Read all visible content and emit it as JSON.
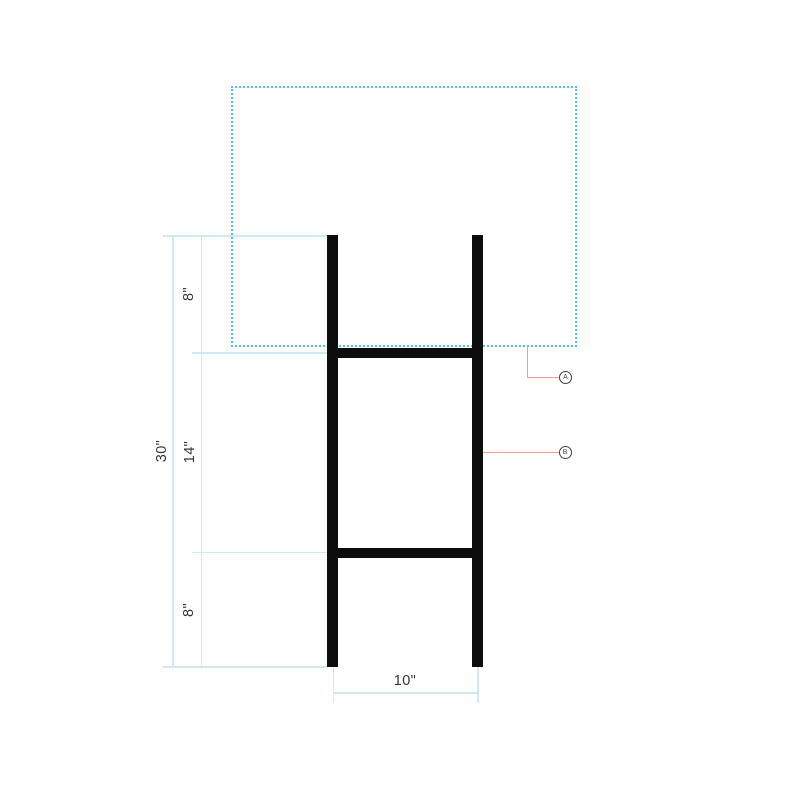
{
  "diagram": {
    "dimensions": {
      "segment_top": "8\"",
      "segment_middle": "14\"",
      "segment_bottom": "8\"",
      "overall_height": "30\"",
      "stake_width": "10\""
    },
    "callouts": {
      "a": "A",
      "b": "B"
    },
    "colors": {
      "panel_outline": "#4ec5e8",
      "dimension_lines": "#cde9f1",
      "leader_lines": "#f49a92",
      "frame": "#0c0c0c",
      "label_text": "#333333",
      "callout_stroke": "#3c4043"
    }
  }
}
